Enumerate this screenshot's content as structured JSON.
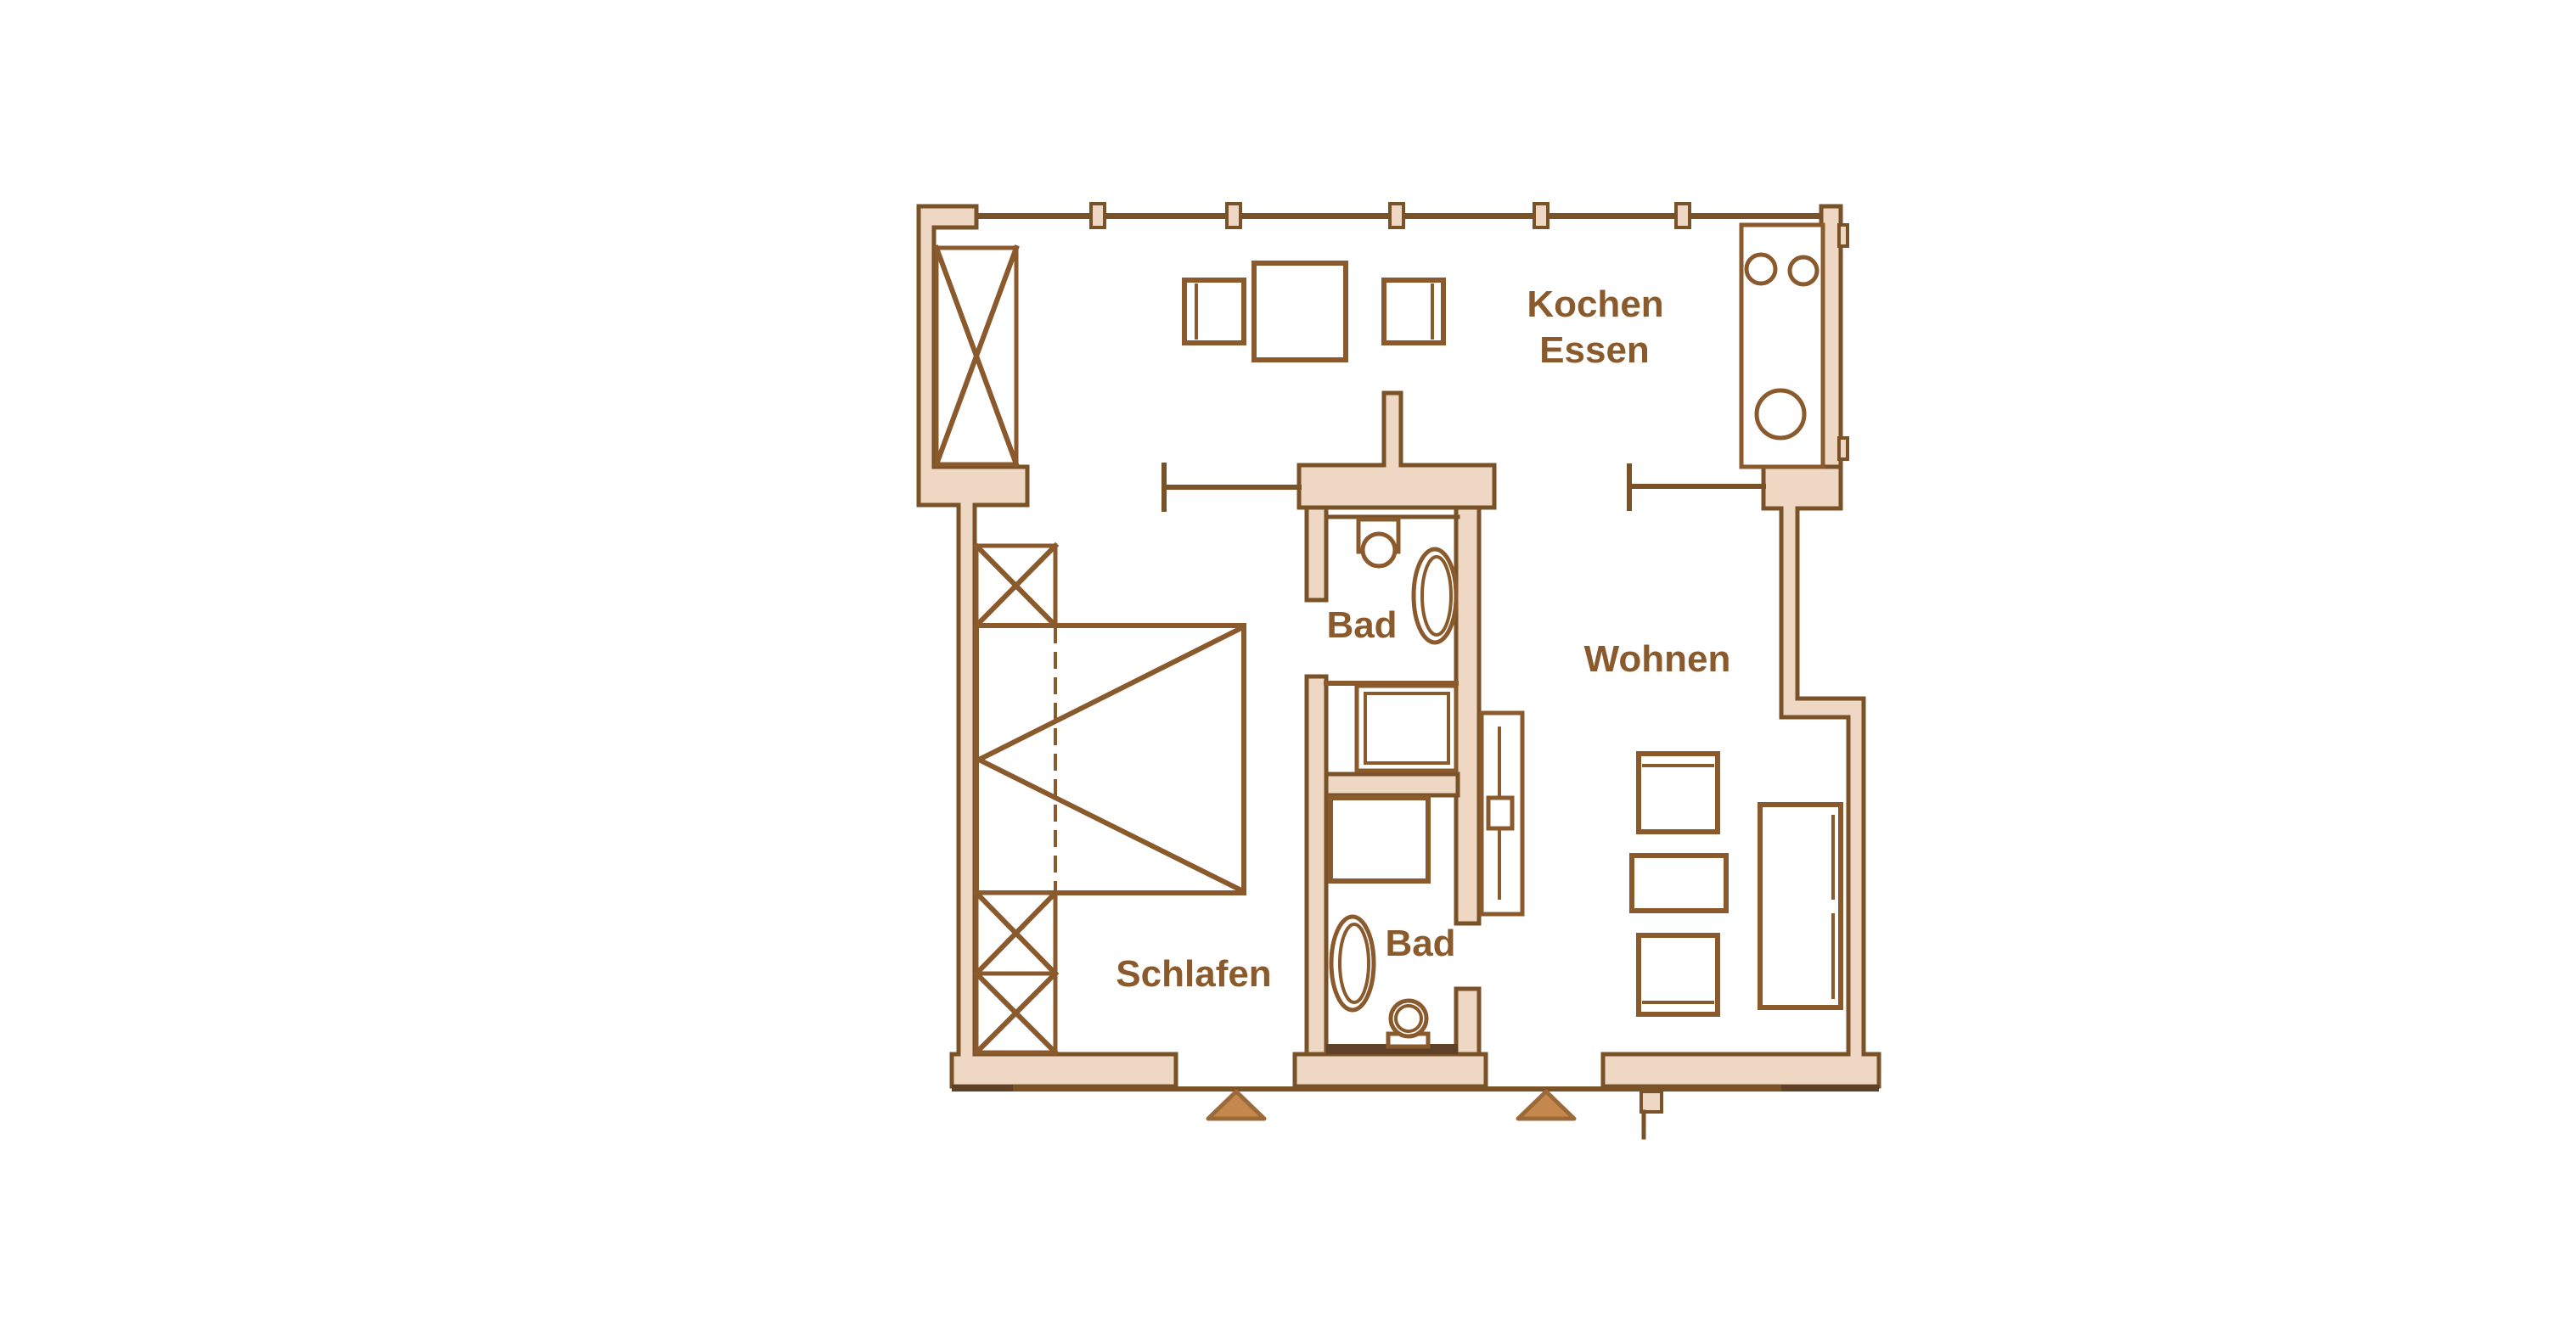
{
  "plan": {
    "title": "apartment-floor-plan",
    "labels": {
      "kochen": "Kochen",
      "essen": "Essen",
      "wohnen": "Wohnen",
      "schlafen": "Schlafen",
      "bad_upper": "Bad",
      "bad_lower": "Bad"
    },
    "colors": {
      "wall_fill": "#eed7c3",
      "wall_line": "#7a5228",
      "furniture_line": "#8a5a2c",
      "dark_accent": "#5e4126",
      "label_text": "#8a5a2c",
      "entrance_arrow_fill": "#c4884f",
      "entrance_arrow_border": "#9c6a38",
      "background": "#ffffff"
    },
    "symbols": [
      "wardrobe-crossbox",
      "nightstand-crossbox",
      "double-crossbox-cupboard",
      "bed-with-fold-line",
      "dining-table",
      "dining-chair",
      "kitchen-unit-with-sink-and-hob",
      "window-tick",
      "door-leaf",
      "toilet",
      "washbasin-oval",
      "shower-tray",
      "bathtub-oval",
      "tall-cabinet",
      "armchair",
      "coffee-table",
      "sofa",
      "entrance-arrow"
    ]
  }
}
